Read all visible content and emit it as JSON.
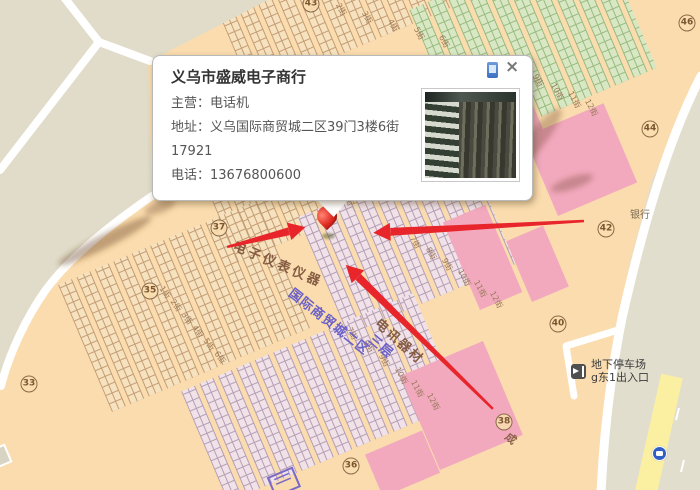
{
  "popup": {
    "title": "义乌市盛威电子商行",
    "lines": [
      "主营：电话机",
      "地址：义乌国际商贸城二区39门3楼6街17921",
      "电话：13676800600"
    ],
    "close_label": "×",
    "icons": {
      "phone": "phone-icon",
      "close": "close-icon",
      "photo": "shop-photo-thumbnail"
    }
  },
  "map": {
    "gate_markers": [
      {
        "label": "33",
        "x": 29,
        "y": 384
      },
      {
        "label": "35",
        "x": 150,
        "y": 291
      },
      {
        "label": "36",
        "x": 351,
        "y": 466
      },
      {
        "label": "37",
        "x": 219,
        "y": 228
      },
      {
        "label": "38",
        "x": 504,
        "y": 422
      },
      {
        "label": "40",
        "x": 558,
        "y": 324
      },
      {
        "label": "42",
        "x": 606,
        "y": 229
      },
      {
        "label": "43",
        "x": 311,
        "y": 4
      },
      {
        "label": "44",
        "x": 650,
        "y": 129
      },
      {
        "label": "46",
        "x": 687,
        "y": 23
      }
    ],
    "street_labels": [
      {
        "text": "电子仪表仪器",
        "x": 236,
        "y": 240,
        "rot": 23,
        "color": "#855C42",
        "size": 13,
        "ls": 3,
        "bold": true
      },
      {
        "text": "国际商贸城二区",
        "x": 294,
        "y": 287,
        "rot": 38,
        "color": "#6A60C8",
        "size": 13,
        "ls": 1,
        "bold": true
      },
      {
        "text": "三层",
        "x": 374,
        "y": 333,
        "rot": 40,
        "color": "#6A60C8",
        "size": 13,
        "ls": 1,
        "bold": true
      },
      {
        "text": "电讯器材",
        "x": 381,
        "y": 317,
        "rot": 42,
        "color": "#855C42",
        "size": 13,
        "ls": 2,
        "bold": true
      },
      {
        "text": "银行",
        "x": 630,
        "y": 211,
        "rot": 0,
        "color": "#7A6B52",
        "size": 10,
        "ls": 0,
        "bold": false
      },
      {
        "text": "成",
        "x": 510,
        "y": 431,
        "rot": 40,
        "color": "#8A6248",
        "size": 11,
        "ls": 0,
        "bold": true
      }
    ],
    "stall_street_labels": [
      {
        "t": "2街",
        "x": 341,
        "y": 2,
        "r": 62
      },
      {
        "t": "3街",
        "x": 367,
        "y": 10,
        "r": 62
      },
      {
        "t": "4街",
        "x": 393,
        "y": 18,
        "r": 62
      },
      {
        "t": "5街",
        "x": 419,
        "y": 26,
        "r": 62
      },
      {
        "t": "6街",
        "x": 444,
        "y": 34,
        "r": 62
      },
      {
        "t": "9街",
        "x": 538,
        "y": 73,
        "r": 62
      },
      {
        "t": "10街",
        "x": 556,
        "y": 82,
        "r": 62
      },
      {
        "t": "11街",
        "x": 573,
        "y": 90,
        "r": 62
      },
      {
        "t": "12街",
        "x": 590,
        "y": 98,
        "r": 62
      },
      {
        "t": "6街",
        "x": 348,
        "y": 192,
        "r": 62
      },
      {
        "t": "7街",
        "x": 415,
        "y": 235,
        "r": 62
      },
      {
        "t": "8街",
        "x": 431,
        "y": 246,
        "r": 62
      },
      {
        "t": "9街",
        "x": 447,
        "y": 257,
        "r": 62
      },
      {
        "t": "10街",
        "x": 463,
        "y": 268,
        "r": 62
      },
      {
        "t": "11街",
        "x": 479,
        "y": 279,
        "r": 62
      },
      {
        "t": "12街",
        "x": 495,
        "y": 290,
        "r": 62
      },
      {
        "t": "1街",
        "x": 164,
        "y": 285,
        "r": 55
      },
      {
        "t": "2街",
        "x": 175,
        "y": 298,
        "r": 55
      },
      {
        "t": "3街",
        "x": 186,
        "y": 311,
        "r": 55
      },
      {
        "t": "4街",
        "x": 197,
        "y": 324,
        "r": 55
      },
      {
        "t": "5街",
        "x": 208,
        "y": 337,
        "r": 55
      },
      {
        "t": "6街",
        "x": 219,
        "y": 350,
        "r": 55
      },
      {
        "t": "7街",
        "x": 352,
        "y": 326,
        "r": 62
      },
      {
        "t": "8街",
        "x": 368,
        "y": 339,
        "r": 62
      },
      {
        "t": "9街",
        "x": 384,
        "y": 353,
        "r": 62
      },
      {
        "t": "10街",
        "x": 400,
        "y": 366,
        "r": 62
      },
      {
        "t": "11街",
        "x": 416,
        "y": 379,
        "r": 62
      },
      {
        "t": "12街",
        "x": 432,
        "y": 392,
        "r": 62
      }
    ],
    "parking": {
      "line1": "地下停车场",
      "line2": "g东1出入口"
    },
    "icons": {
      "pin": "location-pin",
      "bus_stop": "bus-stop-icon",
      "parking": "parking-entrance-icon"
    },
    "colors": {
      "background": "#FADCAE",
      "area_grey": "#E0DCC9",
      "stall_beige": "#F6E2BE",
      "stall_green": "#D9E8C4",
      "stall_lavender": "#F0E2E8",
      "block_pink": "#F2A9BE",
      "road_yellow": "#FBF0A2",
      "arrow_red": "#E8252A",
      "label_blue": "#6A60C8",
      "label_brown": "#855C42"
    }
  }
}
